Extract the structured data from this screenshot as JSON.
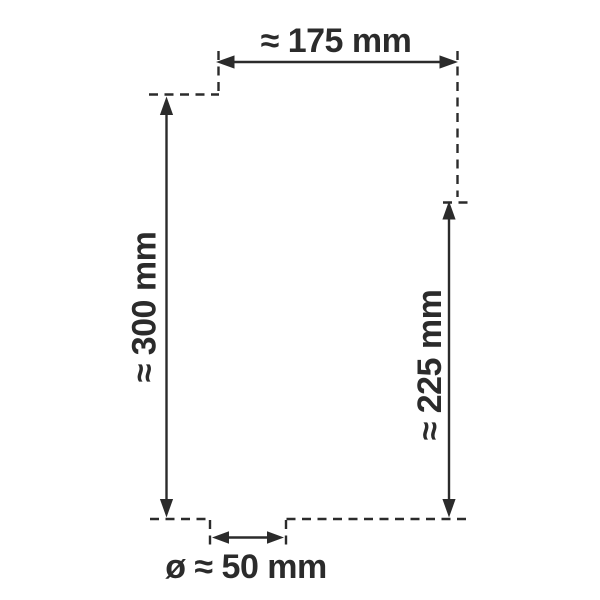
{
  "diagram": {
    "kind": "product-dimension-drawing",
    "unit": "mm",
    "approx_symbol": "≈",
    "diameter_symbol": "ø",
    "colors": {
      "line": "#2b2b2b",
      "background": "#ffffff"
    },
    "dimensions": {
      "width": {
        "label": "≈ 175 mm",
        "value_mm": 175,
        "approximate": true,
        "position": "top",
        "orientation": "horizontal"
      },
      "overall_height": {
        "label": "≈ 300 mm",
        "value_mm": 300,
        "approximate": true,
        "position": "left",
        "orientation": "vertical"
      },
      "right_height": {
        "label": "≈ 225 mm",
        "value_mm": 225,
        "approximate": true,
        "position": "right",
        "orientation": "vertical"
      },
      "base_diameter": {
        "label": "ø ≈ 50 mm",
        "value_mm": 50,
        "approximate": true,
        "is_diameter": true,
        "position": "bottom",
        "orientation": "horizontal"
      }
    }
  }
}
